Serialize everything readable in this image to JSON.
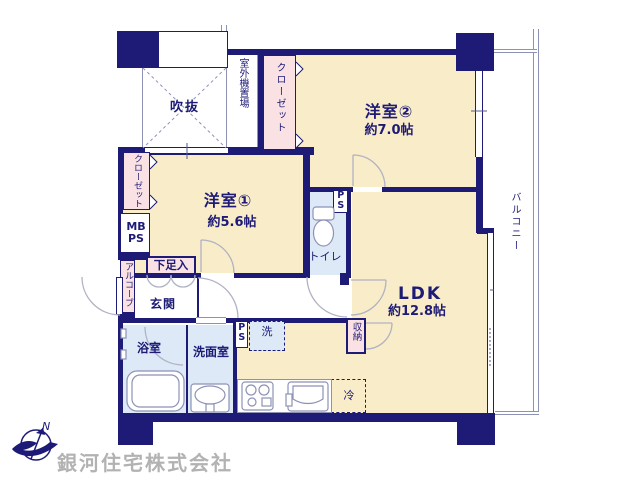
{
  "colors": {
    "navy": "#1d1b76",
    "cream": "#f9ecc9",
    "pink": "#f9e1e4",
    "light_blue": "#dde9f6",
    "line_gray": "#8d92b5",
    "company_text_gray": "#b2b2b2"
  },
  "rooms": {
    "western2": {
      "label": "洋室②",
      "area": "約7.0帖"
    },
    "western1": {
      "label": "洋室①",
      "area": "約5.6帖"
    },
    "ldk": {
      "label": "LDK",
      "area": "約12.8帖"
    },
    "void": "吹抜",
    "outdoor_unit": "室外機置場",
    "closet_top": "クローゼット",
    "closet_left": "クローゼット",
    "mb_ps": "MB PS",
    "alcove": "アルコーブ",
    "shoe_cabinet": "下足入",
    "entrance": "玄関",
    "toilet": "トイレ",
    "ps_toilet": "PS",
    "ps_hallway": "PS",
    "washer": "洗",
    "bathroom": "浴室",
    "washroom": "洗面室",
    "storage": "収納",
    "fridge": "冷",
    "balcony": "バルコニー"
  },
  "compass": {
    "north_label": "N"
  },
  "footer": {
    "company_name": "銀河住宅株式会社"
  }
}
